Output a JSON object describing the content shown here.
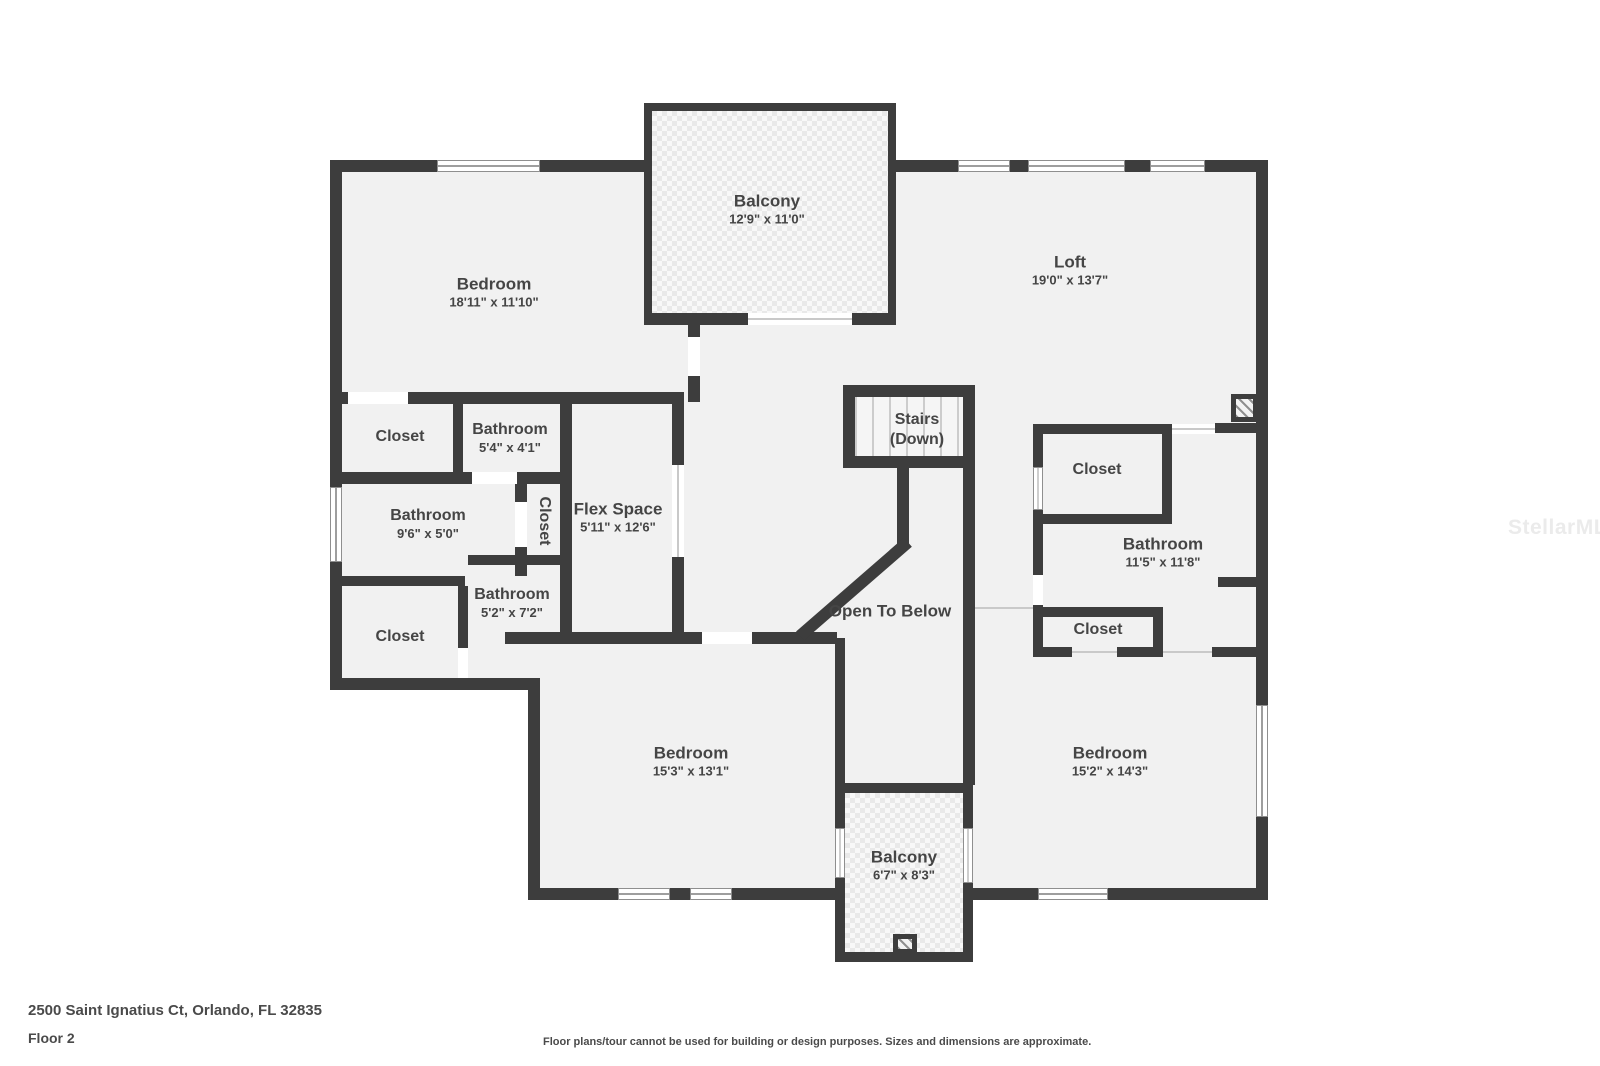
{
  "rooms": [
    {
      "id": "balcony-top",
      "name": "Balcony",
      "dims": "12'9\" x 11'0\""
    },
    {
      "id": "bedroom-top-left",
      "name": "Bedroom",
      "dims": "18'11\" x 11'10\""
    },
    {
      "id": "loft",
      "name": "Loft",
      "dims": "19'0\" x 13'7\""
    },
    {
      "id": "closet-top-left",
      "name": "Closet",
      "dims": ""
    },
    {
      "id": "bathroom-small",
      "name": "Bathroom",
      "dims": "5'4\" x 4'1\""
    },
    {
      "id": "bathroom-left",
      "name": "Bathroom",
      "dims": "9'6\" x 5'0\""
    },
    {
      "id": "closet-vertical",
      "name": "Closet",
      "dims": ""
    },
    {
      "id": "flex-space",
      "name": "Flex Space",
      "dims": "5'11\" x 12'6\""
    },
    {
      "id": "stairs",
      "name": "Stairs",
      "dims": "(Down)"
    },
    {
      "id": "closet-top-right",
      "name": "Closet",
      "dims": ""
    },
    {
      "id": "bathroom-right",
      "name": "Bathroom",
      "dims": "11'5\" x 11'8\""
    },
    {
      "id": "open-to-below",
      "name": "Open To Below",
      "dims": ""
    },
    {
      "id": "bathroom-mid-left",
      "name": "Bathroom",
      "dims": "5'2\" x 7'2\""
    },
    {
      "id": "closet-bottom-left",
      "name": "Closet",
      "dims": ""
    },
    {
      "id": "closet-bottom-right",
      "name": "Closet",
      "dims": ""
    },
    {
      "id": "bedroom-bottom-left",
      "name": "Bedroom",
      "dims": "15'3\" x 13'1\""
    },
    {
      "id": "bedroom-bottom-right",
      "name": "Bedroom",
      "dims": "15'2\" x 14'3\""
    },
    {
      "id": "balcony-bottom",
      "name": "Balcony",
      "dims": "6'7\" x 8'3\""
    }
  ],
  "footer": {
    "address": "2500 Saint Ignatius Ct, Orlando, FL 32835",
    "floor_label": "Floor 2",
    "disclaimer": "Floor plans/tour cannot be used for building or design purposes. Sizes and dimensions are approximate."
  },
  "watermark": "StellarMLS",
  "colors": {
    "wall": "#3d3d3d",
    "floor": "#f1f1f1",
    "background": "#ffffff",
    "text": "#454545",
    "watermark": "#ebebeb"
  }
}
